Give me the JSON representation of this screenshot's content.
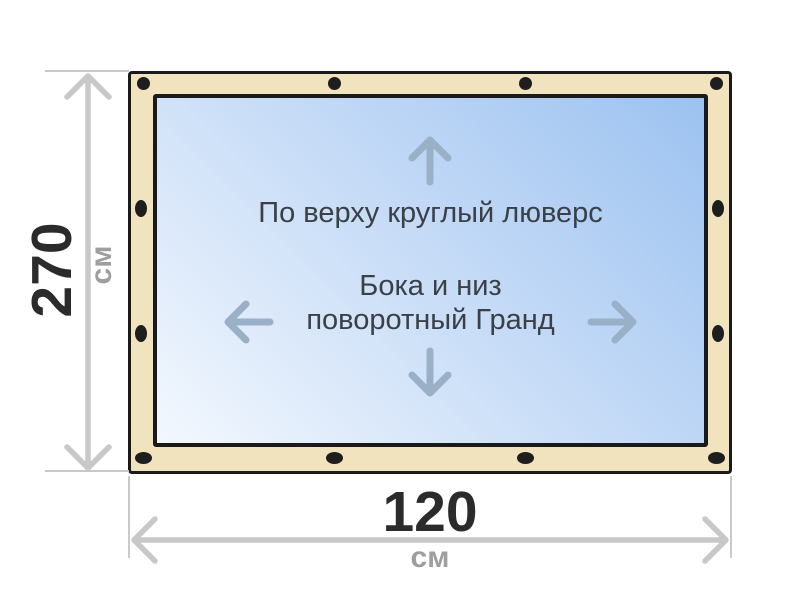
{
  "banner": {
    "top_note": "По верху круглый люверс",
    "center_note_line1": "Бока и низ",
    "center_note_line2": "поворотный Гранд",
    "grommet_count": {
      "top": 4,
      "bottom": 4,
      "left": 2,
      "right": 2
    }
  },
  "dimensions": {
    "height": {
      "value": "270",
      "unit": "см"
    },
    "width": {
      "value": "120",
      "unit": "см"
    }
  },
  "icons": {
    "up": "arrow-up-icon",
    "down": "arrow-down-icon",
    "left": "arrow-left-icon",
    "right": "arrow-right-icon"
  },
  "colors": {
    "frame_fill": "#f2e3bf",
    "outline": "#1a1a1a",
    "banner_gradient_start": "#9cc2f0",
    "banner_gradient_end": "#f3f8fe",
    "direction_arrow": "#9ab0c7",
    "dimension_line": "#c8c8c8",
    "note_text": "#3a4046",
    "dimension_value": "#2b2b2b",
    "dimension_unit": "#9e9e9e"
  }
}
